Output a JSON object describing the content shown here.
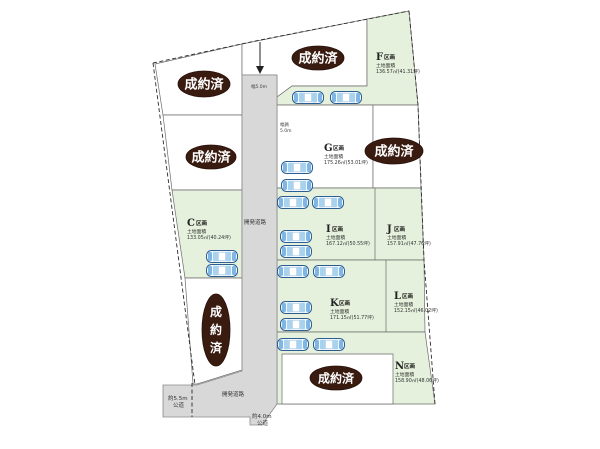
{
  "sold": {
    "label": "成約済",
    "chars": [
      "成",
      "約",
      "済"
    ]
  },
  "lots": [
    {
      "letter": "C",
      "suffix": "区画",
      "area_label": "土地面積",
      "area_value": "133.05㎡(40.24坪)"
    },
    {
      "letter": "F",
      "suffix": "区画",
      "area_label": "土地面積",
      "area_value": "136.57㎡(41.31坪)"
    },
    {
      "letter": "G",
      "suffix": "区画",
      "area_label": "土地面積",
      "area_value": "175.26㎡(53.01坪)"
    },
    {
      "letter": "I",
      "suffix": "区画",
      "area_label": "土地面積",
      "area_value": "167.12㎡(50.55坪)"
    },
    {
      "letter": "J",
      "suffix": "区画",
      "area_label": "土地面積",
      "area_value": "157.91㎡(47.76坪)"
    },
    {
      "letter": "K",
      "suffix": "区画",
      "area_label": "土地面積",
      "area_value": "171.15㎡(51.77坪)"
    },
    {
      "letter": "L",
      "suffix": "区画",
      "area_label": "土地面積",
      "area_value": "152.15㎡(46.02坪)"
    },
    {
      "letter": "N",
      "suffix": "区画",
      "area_label": "土地面積",
      "area_value": "158.90㎡(48.06坪)"
    }
  ],
  "roads": {
    "development_road": "開発道路",
    "development_road_bottom": "開発道路",
    "public_road_left_line1": "約5.5m",
    "public_road_left_line2": "公道",
    "public_road_right_line1": "約4.0m",
    "public_road_right_line2": "公道",
    "width_note_top": "幅5.0m",
    "width_note_side_line1": "幅員",
    "width_note_side_line2": "5.0m"
  },
  "colors": {
    "lot_green": "#e5f1dc",
    "road_gray": "#d8d8d8",
    "sold_brown": "#3a1b10",
    "boundary": "#2b2b2b"
  }
}
